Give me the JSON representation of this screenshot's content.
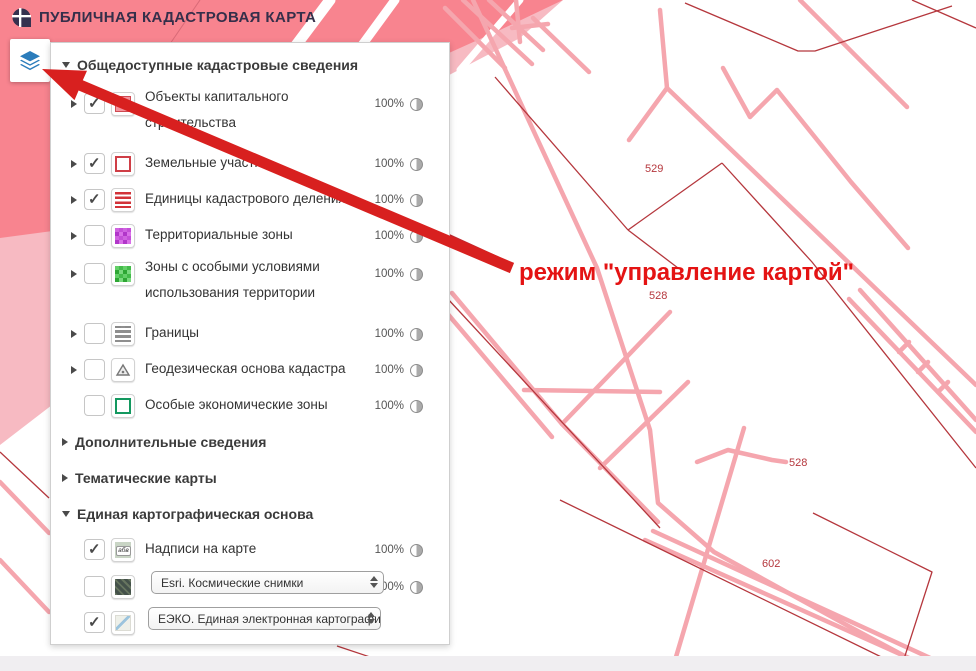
{
  "header": {
    "title": "ПУБЛИЧНАЯ КАДАСТРОВАЯ КАРТА"
  },
  "toolbar": {
    "layers_button_tooltip": "режим управления картой"
  },
  "annotation": {
    "text": "режим \"управление картой\""
  },
  "layers_panel": {
    "sections": [
      {
        "label": "Общедоступные кадастровые сведения",
        "expanded": true
      },
      {
        "label": "Дополнительные сведения",
        "expanded": false
      },
      {
        "label": "Тематические карты",
        "expanded": false
      },
      {
        "label": "Единая картографическая основа",
        "expanded": true
      }
    ],
    "layers": [
      {
        "label": "Объекты капитального строительства",
        "checked": true,
        "opacity": "100%",
        "icon": "construction-objects-icon"
      },
      {
        "label": "Земельные участки",
        "checked": true,
        "opacity": "100%",
        "icon": "land-parcels-icon"
      },
      {
        "label": "Единицы кадастрового деления",
        "checked": true,
        "opacity": "100%",
        "icon": "cadastral-division-icon"
      },
      {
        "label": "Территориальные зоны",
        "checked": false,
        "opacity": "100%",
        "icon": "territorial-zones-icon"
      },
      {
        "label": "Зоны с особыми условиями использования территории",
        "checked": false,
        "opacity": "100%",
        "icon": "special-conditions-zones-icon"
      },
      {
        "label": "Границы",
        "checked": false,
        "opacity": "100%",
        "icon": "borders-icon"
      },
      {
        "label": "Геодезическая основа кадастра",
        "checked": false,
        "opacity": "100%",
        "icon": "geodetic-basis-icon"
      },
      {
        "label": "Особые экономические зоны",
        "checked": false,
        "opacity": "100%",
        "icon": "special-economic-zones-icon"
      },
      {
        "label": "Надписи на карте",
        "checked": true,
        "opacity": "100%",
        "icon": "map-labels-icon",
        "icon_text": "абв"
      },
      {
        "label": "Esri. Космические снимки",
        "checked": false,
        "opacity": "100%",
        "icon": "satellite-imagery-icon",
        "control": "select"
      },
      {
        "label": "ЕЭКО. Единая электронная картографичес",
        "checked": true,
        "icon": "base-map-icon",
        "control": "select"
      }
    ]
  },
  "map": {
    "labels": [
      {
        "text": "529"
      },
      {
        "text": "528"
      },
      {
        "text": "528"
      },
      {
        "text": "602"
      }
    ]
  },
  "colors": {
    "annotation_red": "#e41313",
    "road_pink": "#f5a6ae",
    "parcel_line_red": "#b5373d",
    "area_fill_pink": "#f7bac2",
    "area_fill_dark_pink": "#f8848f",
    "layers_icon_blue": "#2b7cbb"
  }
}
